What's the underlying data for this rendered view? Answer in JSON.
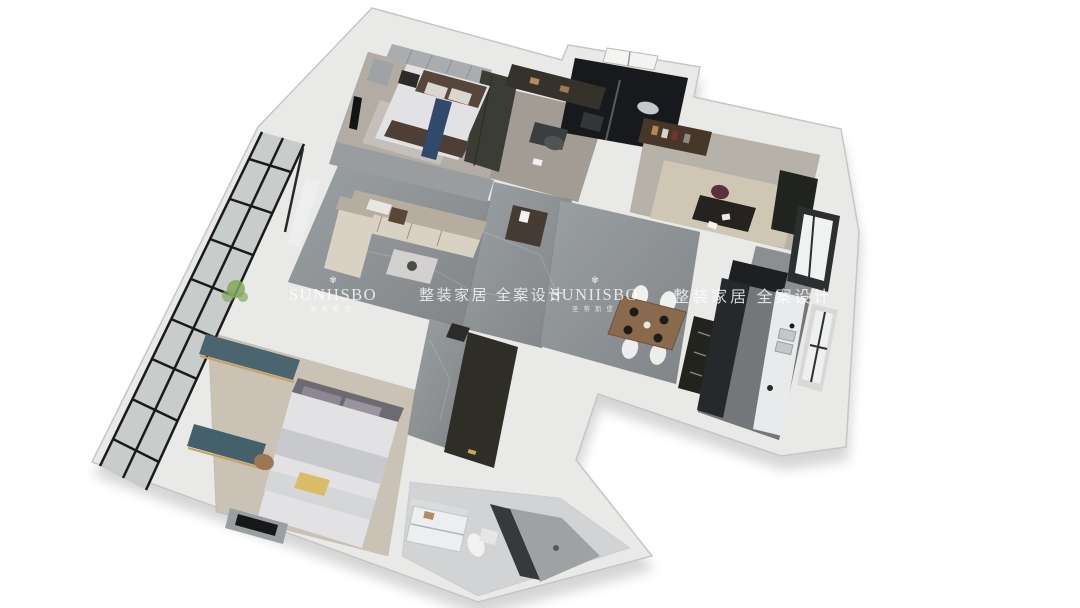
{
  "watermarks": {
    "logo_icon": "crown-flourish-icon",
    "logo_icon_glyph": "✾",
    "instances": [
      {
        "brand": "SUNIISBO",
        "brand_sub": "圣蒂斯堡",
        "tagline": "整装家居 全案设计"
      },
      {
        "brand": "SUNIISBO",
        "brand_sub": "圣蒂斯堡",
        "tagline": "整装家居 全案设计"
      }
    ]
  },
  "colors": {
    "background": "#ffffff",
    "wall_slab": "#e9e9e7",
    "wall_edge": "#c6c6c4",
    "wall_face_gray": "#9a9da0",
    "floor_marble_light": "#9ba0a3",
    "floor_marble_dark": "#808487",
    "floor_wood_master": "#cbc2b6",
    "floor_bedroom": "#b2aca4",
    "carpet_study": "#cfc6b4",
    "bathroom_dark": "#17191c",
    "bathroom_white": "#d2d3d5",
    "cabinet_dark": "#3b3c34",
    "sofa_cream": "#d9d2c2",
    "sofa_taupe": "#b7ad9f",
    "bed_white": "#e2e2e4",
    "headboard_brown": "#574639",
    "runner_blue": "#31496b",
    "curtain_teal": "#4a6570",
    "pillow_yellow": "#d8bd66",
    "table_wood": "#8a6a4c",
    "plant_green": "#84a85e",
    "watermark_text": "rgba(255,255,255,0.78)"
  }
}
